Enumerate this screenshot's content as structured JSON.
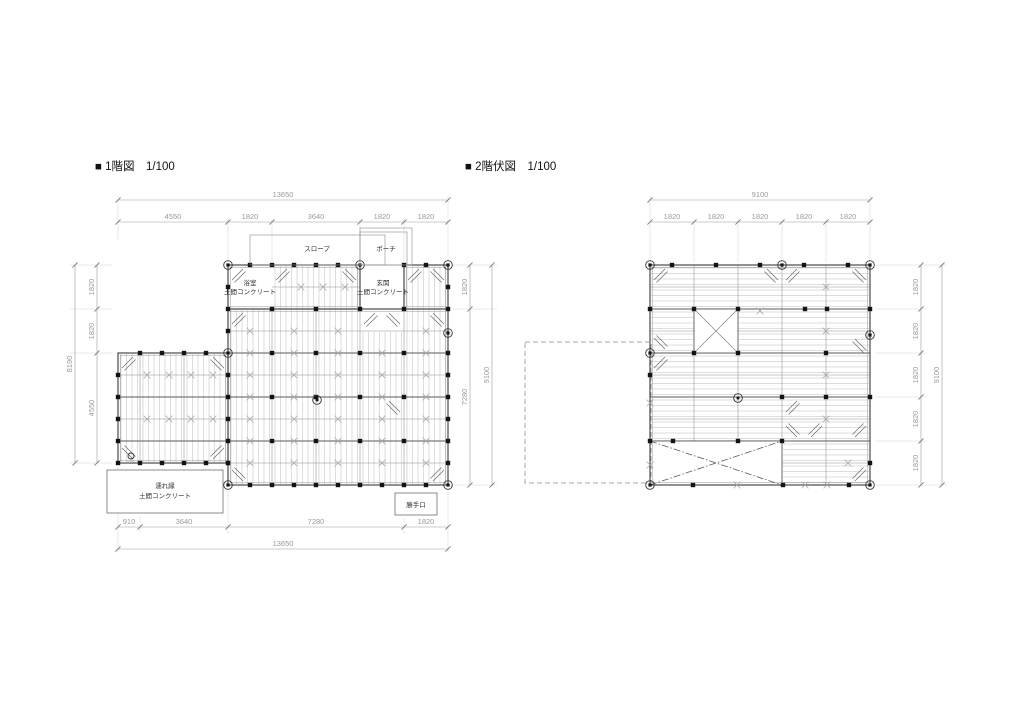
{
  "page": {
    "background": "#ffffff",
    "line_color": "#3a3a3a",
    "dim_color": "#9a9a9a"
  },
  "plans": [
    {
      "title": "■ 1階図　1/100",
      "labels": {
        "slope": "スロープ",
        "porch": "ポーチ",
        "bath_line1": "浴室",
        "bath_line2": "土間コンクリート",
        "entrance_line1": "玄関",
        "entrance_line2": "土間コンクリート",
        "nureen_line1": "濡れ縁",
        "nureen_line2": "土間コンクリート",
        "kitchen_door": "勝手口"
      },
      "dims": {
        "top_overall": "13650",
        "top_segments": [
          "4550",
          "1820",
          "3640",
          "1820",
          "1820"
        ],
        "bottom_overall": "13650",
        "bottom_segments": [
          "910",
          "3640",
          "7280",
          "1820"
        ],
        "left_overall": "8190",
        "left_segments": [
          "1820",
          "1820",
          "4550"
        ],
        "right_overall": "9100",
        "right_segments": [
          "1820",
          "7280"
        ]
      }
    },
    {
      "title": "■ 2階伏図　1/100",
      "labels": {},
      "dims": {
        "top_overall": "9100",
        "top_segments": [
          "1820",
          "1820",
          "1820",
          "1820",
          "1820"
        ],
        "right_overall": "9100",
        "right_segments": [
          "1820",
          "1820",
          "1820",
          "1820",
          "1820"
        ]
      }
    }
  ]
}
